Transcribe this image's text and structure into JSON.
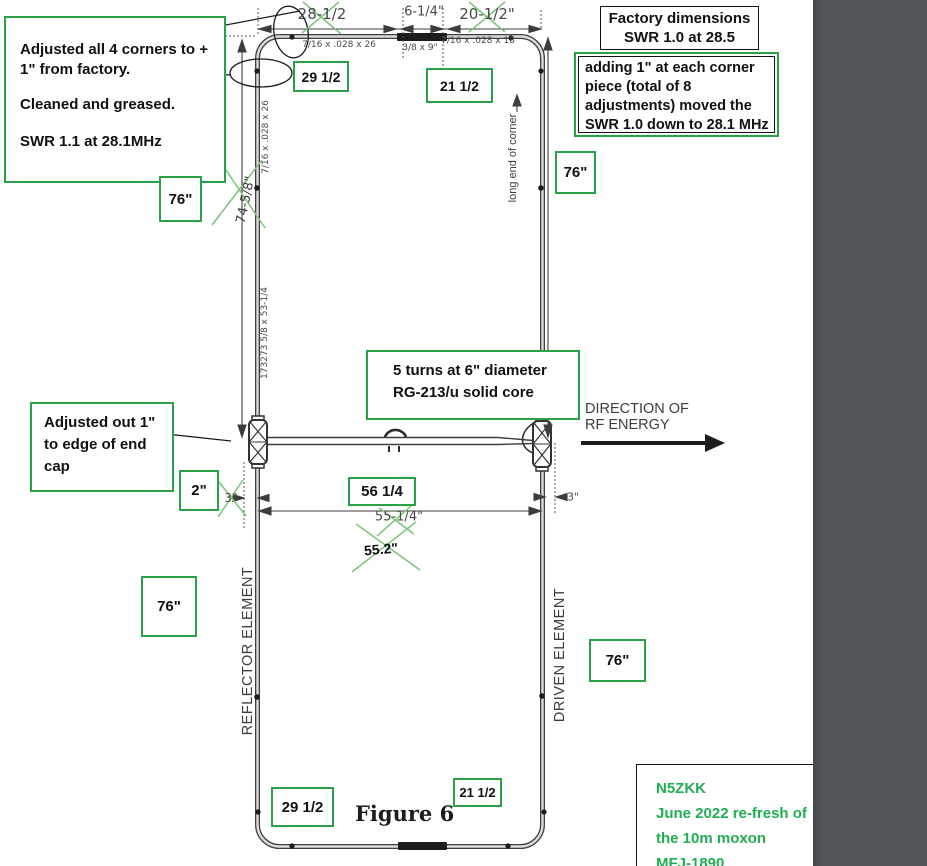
{
  "figure": {
    "caption": "Figure 6"
  },
  "colors": {
    "annotation_green_border": "#2aa148",
    "credit_text_green": "#1fae52",
    "cross_out_green": "#7cc47c",
    "lineart_black": "#3f3f3f",
    "cad_text_gray": "#4a4a4a",
    "side_panel_gray": "#53565a"
  },
  "notes": {
    "adjusted_corners": {
      "line1": "Adjusted all 4 corners to +",
      "line2": "1\" from factory.",
      "line3": "Cleaned and greased.",
      "line4": "SWR 1.1 at 28.1MHz"
    },
    "factory": {
      "line1": "Factory dimensions",
      "line2": "SWR 1.0 at 28.5"
    },
    "adding": {
      "line1": "adding 1\" at each corner",
      "line2": "piece (total of 8",
      "line3": "adjustments) moved the",
      "line4": "SWR 1.0 down to 28.1 MHz"
    },
    "coil": {
      "line1": "5 turns at 6\" diameter",
      "line2": "RG-213/u solid core"
    },
    "adjusted_out": {
      "line1": "Adjusted out 1\"",
      "line2": "to edge of end",
      "line3": "cap"
    },
    "credit": {
      "line1": "N5ZKK",
      "line2": "June 2022 re-fresh of",
      "line3": "the 10m moxon",
      "line4": "MFJ-1890"
    }
  },
  "labels": {
    "direction1": "DIRECTION OF",
    "direction2": "RF ENERGY",
    "reflector": "REFLECTOR ELEMENT",
    "driven": "DRIVEN ELEMENT",
    "long_end": "long end of corner"
  },
  "dims": {
    "top_left": "28-1/2",
    "top_mid": "6-1/4\"",
    "top_right": "20-1/2\"",
    "tube_top_left": "7/16 x .028 x 26",
    "tube_top_mid": "3/8 x 9\"",
    "tube_top_right": "7/16 x .028 x 18",
    "tube_left_upper": "7/16 x .028 x 26",
    "tube_left_lower": "173273 5/8 x 53-1/4",
    "height_left": "74-5/8\"",
    "span_mid": "55-1/4\"",
    "span_hand": "55.2\"",
    "gap_left_old": "3\"",
    "gap_right": "3\""
  },
  "green_boxes": {
    "top_29": "29 1/2",
    "top_21": "21 1/2",
    "h76_lt": "76\"",
    "h76_rt": "76\"",
    "h76_lb": "76\"",
    "h76_rb": "76\"",
    "gap_2": "2\"",
    "span_56": "56 1/4",
    "bottom_29": "29 1/2",
    "bottom_21": "21 1/2"
  }
}
